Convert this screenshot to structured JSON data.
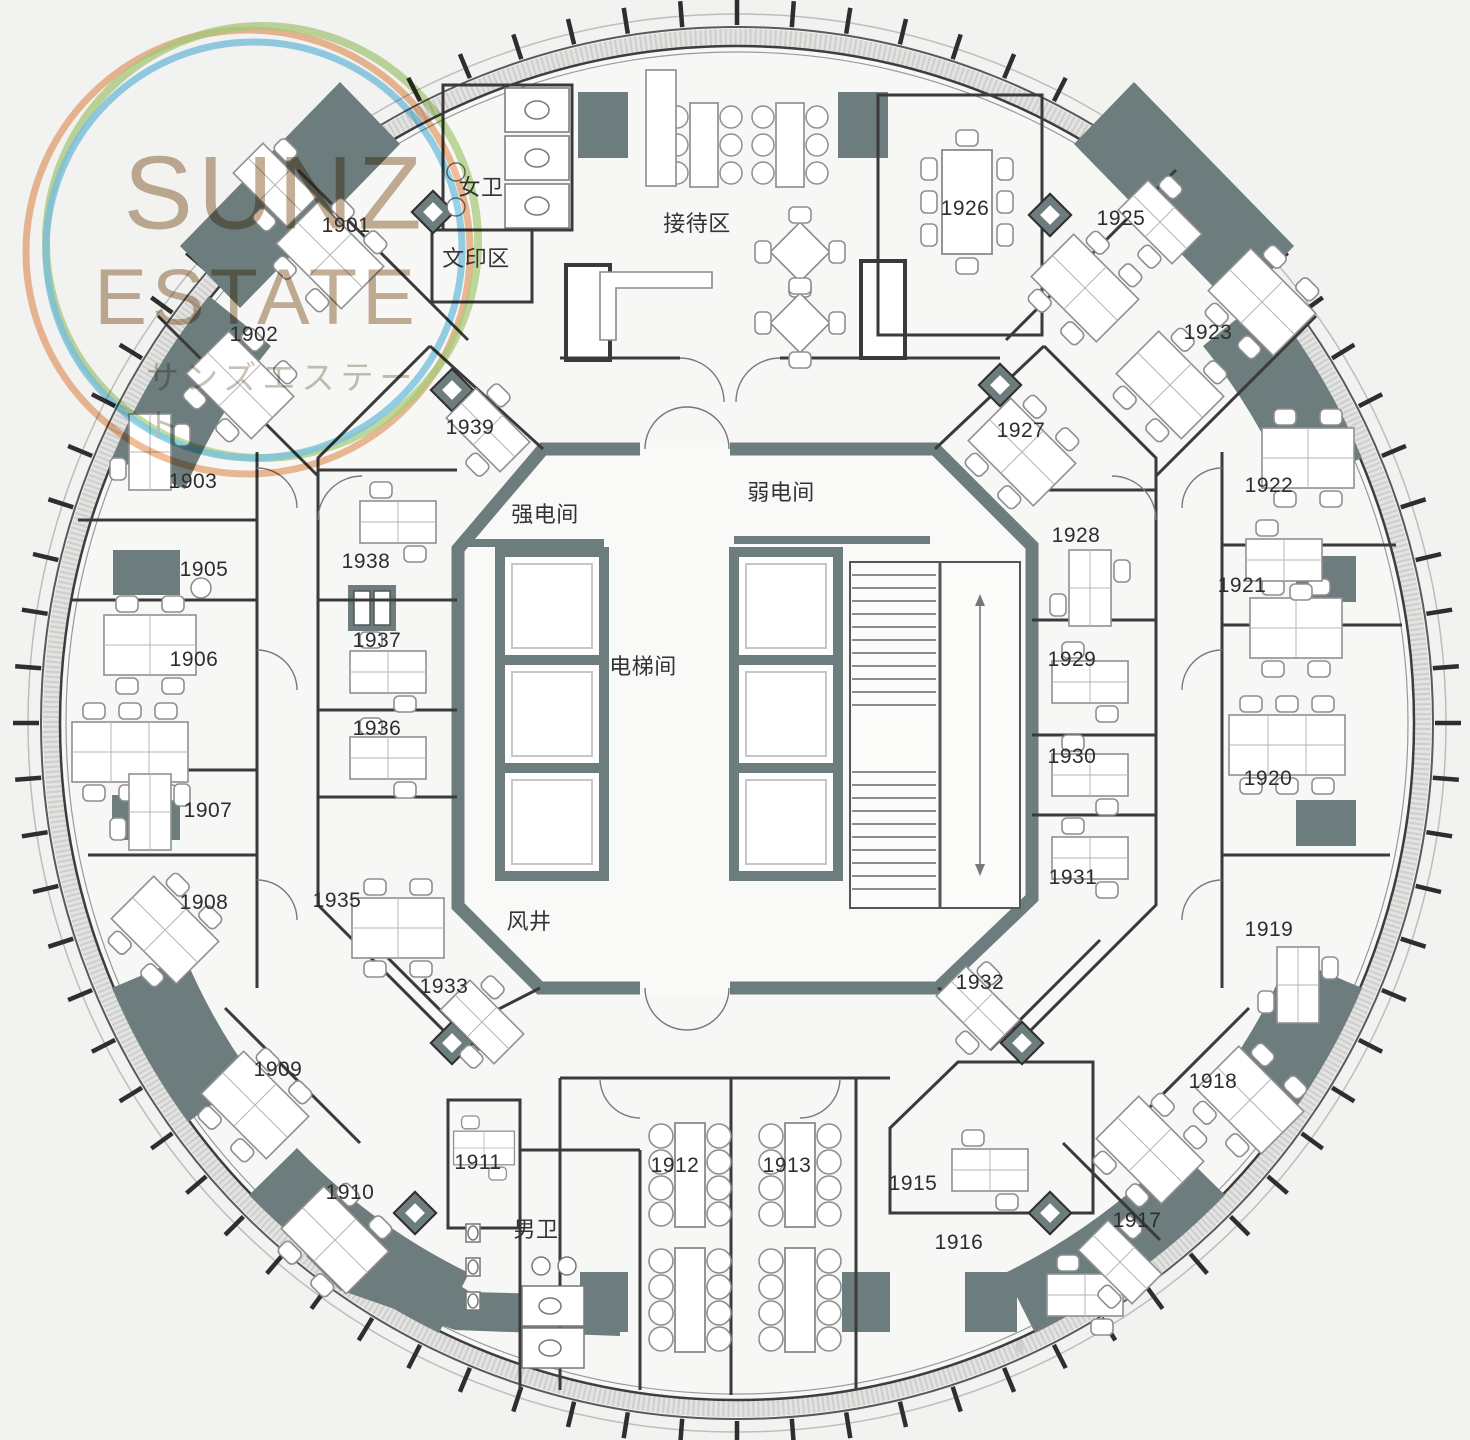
{
  "logo": {
    "line1": "SUNZ",
    "line2": "ESTATE",
    "subtitle": "サンズエステート"
  },
  "core_labels": {
    "strong_power": "强电间",
    "weak_power": "弱电间",
    "elevator_hall": "电梯间",
    "air_shaft": "风井"
  },
  "area_labels": {
    "reception": "接待区",
    "women_wc": "女卫",
    "print_area": "文印区",
    "men_wc": "男卫"
  },
  "rooms": {
    "1901": "1901",
    "1902": "1902",
    "1903": "1903",
    "1905": "1905",
    "1906": "1906",
    "1907": "1907",
    "1908": "1908",
    "1909": "1909",
    "1910": "1910",
    "1911": "1911",
    "1912": "1912",
    "1913": "1913",
    "1915": "1915",
    "1916": "1916",
    "1917": "1917",
    "1918": "1918",
    "1919": "1919",
    "1920": "1920",
    "1921": "1921",
    "1922": "1922",
    "1923": "1923",
    "1925": "1925",
    "1926": "1926",
    "1927": "1927",
    "1928": "1928",
    "1929": "1929",
    "1930": "1930",
    "1931": "1931",
    "1932": "1932",
    "1933": "1933",
    "1935": "1935",
    "1936": "1936",
    "1937": "1937",
    "1938": "1938",
    "1939": "1939"
  },
  "colors": {
    "wall_slate": "#6d7c7c",
    "line_dark": "#3a3a3a",
    "ring_orange": "#eca36f",
    "ring_green": "#a5cc70",
    "ring_blue": "#6fc2e4",
    "logo_text": "#b29776"
  }
}
